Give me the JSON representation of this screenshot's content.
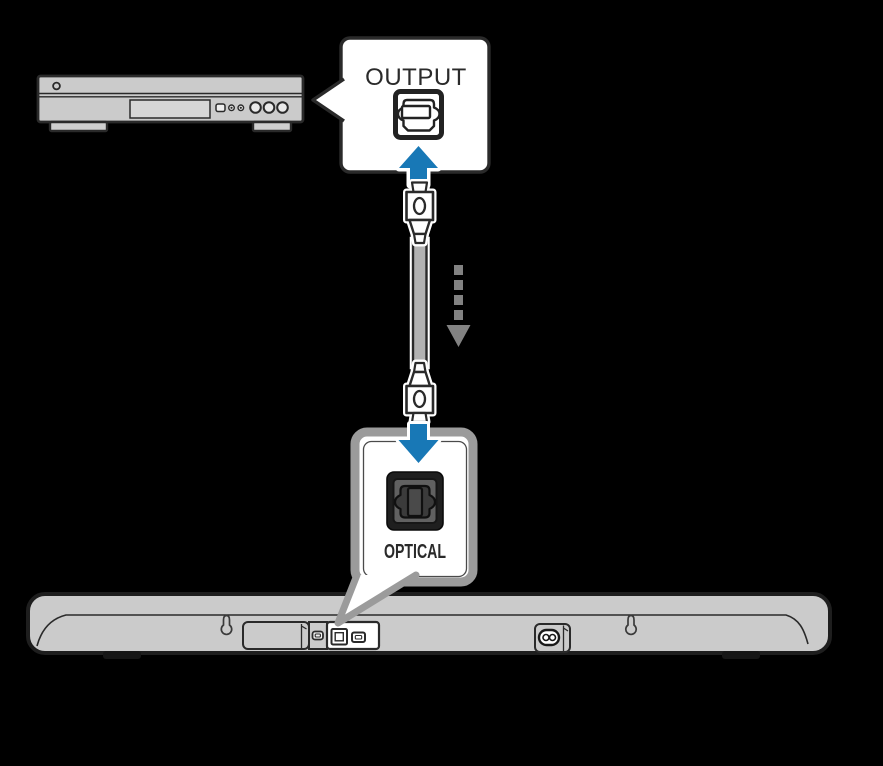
{
  "labels": {
    "output": "OUTPUT",
    "optical": "OPTICAL"
  },
  "colors": {
    "background": "#000000",
    "accent_blue": "#1878b6",
    "device_gray": "#cbcbcb",
    "outline_dark": "#2a2a2a",
    "callout_border_gray": "#9b9b9b",
    "dashed_arrow_gray": "#828282",
    "cable_gray": "#b2b2b2",
    "port_panel_dark": "#1f1f1f"
  },
  "components": {
    "source_device": "disc-player-illustration",
    "source_port": "toslink-output-port-icon",
    "cable": "digital-optical-cable",
    "target_device": "soundbar-rear-illustration",
    "target_port": "optical-input-jack-icon"
  }
}
